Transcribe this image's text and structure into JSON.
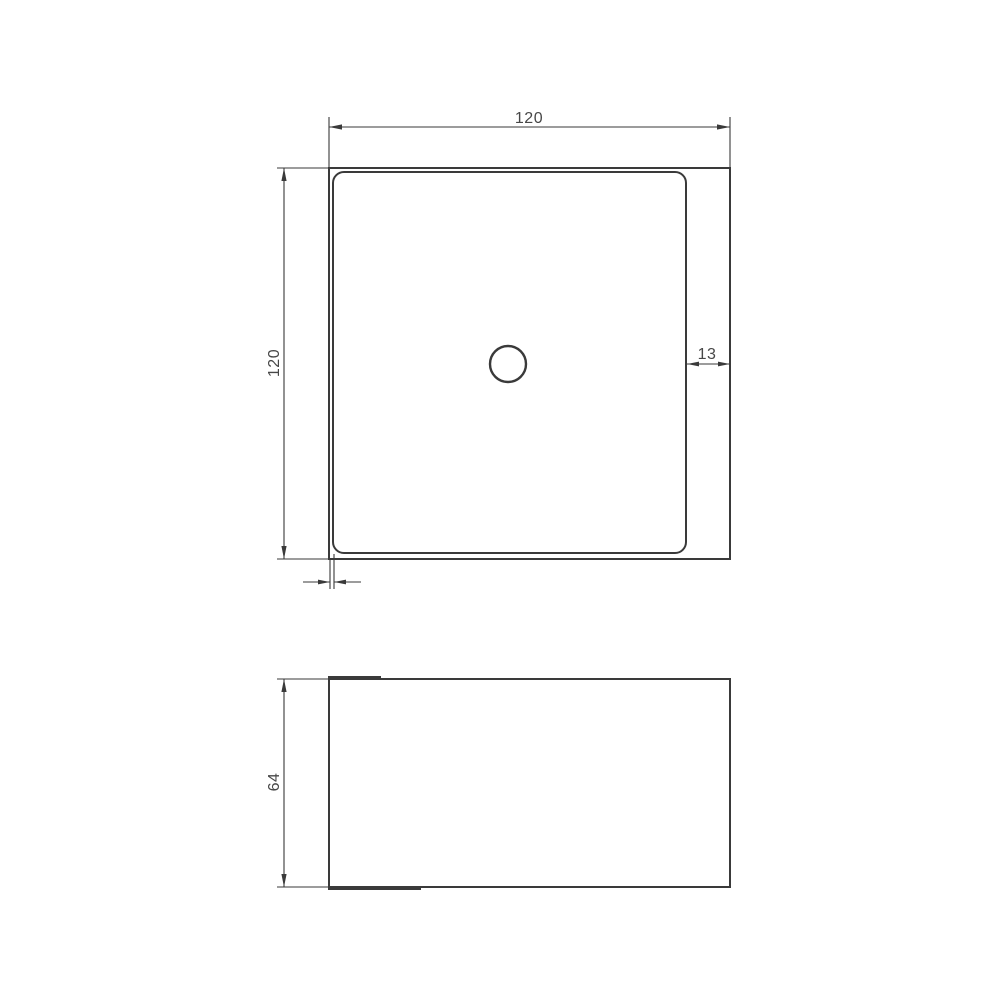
{
  "colors": {
    "line": "#3a3a3a",
    "text": "#474747",
    "background": "#ffffff"
  },
  "views": {
    "top": {
      "width_label": "120",
      "height_label": "120",
      "right_edge_offset_label": "13"
    },
    "side": {
      "height_label": "64"
    }
  }
}
